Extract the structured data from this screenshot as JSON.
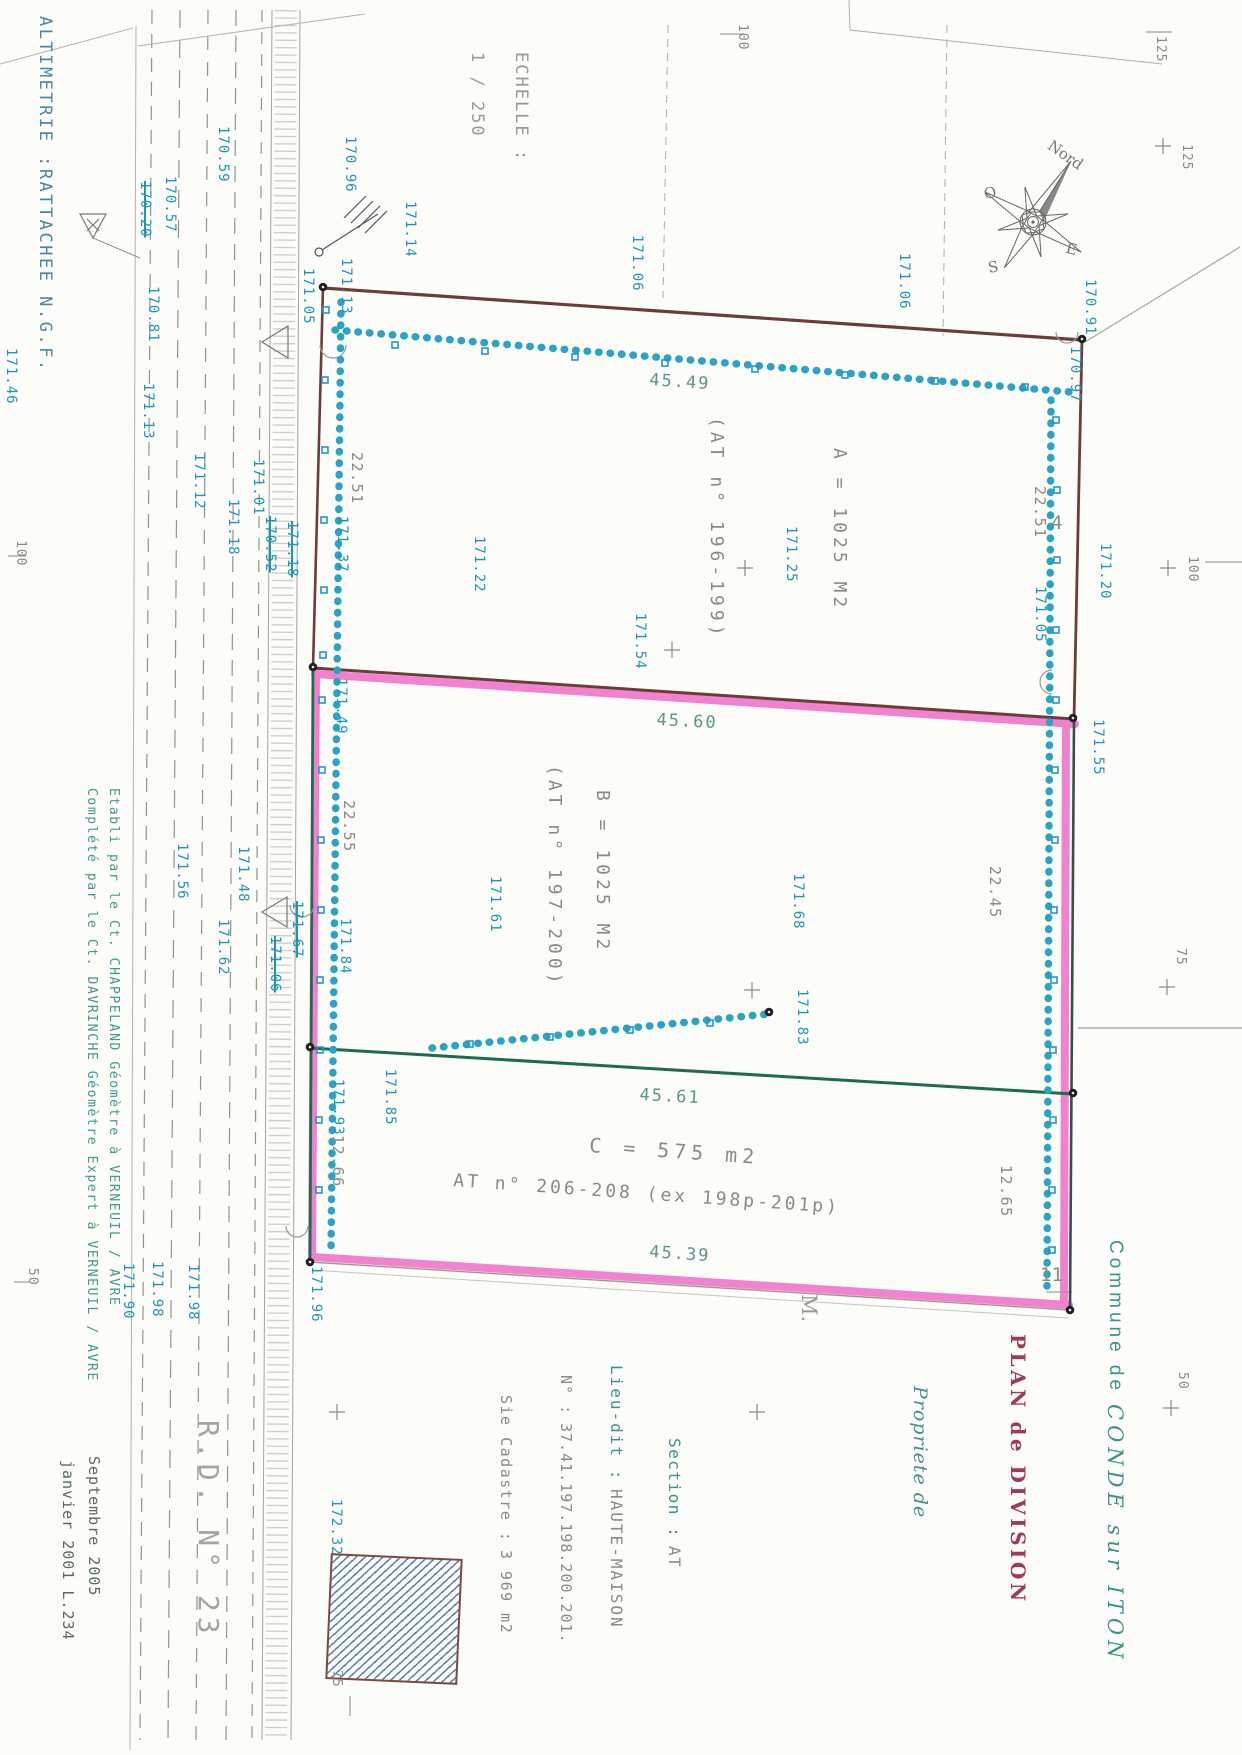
{
  "plan": {
    "altimetrie": "ALTIMETRIE :RATTACHEE N.G.F.",
    "scale_label": "ECHELLE :",
    "scale_value": "1 / 250",
    "road_name": "R.D. N° 23",
    "compass": {
      "north": "Nord",
      "west": "O",
      "east": "E",
      "south": "S"
    }
  },
  "title_block": {
    "commune_label": "Commune de",
    "commune_name": "CONDE sur ITON",
    "plan_title": "PLAN de DIVISION",
    "owner_label": "Propriete de",
    "owner_name": "M.",
    "section_label": "Section :",
    "section_value": "AT",
    "lieu_label": "Lieu-dit :",
    "lieu_value": "HAUTE-MAISON",
    "numero_label": "N° :",
    "numero_value": "37.41.197.198.200.201.",
    "cadastre_label": "Sie Cadastre :",
    "cadastre_value": "3 969 m2"
  },
  "credits": {
    "line1": "Complété par le Ct. DAVRINCHE  Géomètre Expert à VERNEUIL / AVRE",
    "line2": "Etabli par le Ct. CHAPPELAND  Géomètre à VERNEUIL / AVRE",
    "date1": "Septembre 2005",
    "date2": "janvier 2001  L.234"
  },
  "parcels": [
    {
      "id": "A",
      "area": "A = 1025 M2",
      "at": "(AT n° 196-199)"
    },
    {
      "id": "B",
      "area": "B = 1025 M2",
      "at": "(AT n° 197-200)"
    },
    {
      "id": "C",
      "area": "C = 575 m2",
      "at": "AT n° 206-208 (ex 198p-201p)"
    }
  ],
  "dimensions": [
    {
      "v": "45.49"
    },
    {
      "v": "45.60"
    },
    {
      "v": "45.61"
    },
    {
      "v": "45.39"
    },
    {
      "v": "22.51"
    },
    {
      "v": "22.51"
    },
    {
      "v": "22.55"
    },
    {
      "v": "22.45"
    },
    {
      "v": "12.66"
    },
    {
      "v": "12.65"
    }
  ],
  "point_numbers": [
    {
      "v": "4"
    },
    {
      "v": "11"
    }
  ],
  "grid_marks": [
    "125",
    "125",
    "100",
    "100",
    "75",
    "50",
    "100",
    "50",
    "75"
  ],
  "spot_elevations": [
    {
      "v": "170.57"
    },
    {
      "v": "170.20",
      "struck": true
    },
    {
      "v": "170.81"
    },
    {
      "v": "171.46"
    },
    {
      "v": "171.13"
    },
    {
      "v": "170.59"
    },
    {
      "v": "170.96"
    },
    {
      "v": "171.14"
    },
    {
      "v": "171.05"
    },
    {
      "v": "171.13"
    },
    {
      "v": "171.06"
    },
    {
      "v": "171.06"
    },
    {
      "v": "170.91"
    },
    {
      "v": "170.97"
    },
    {
      "v": "171.12"
    },
    {
      "v": "171.01"
    },
    {
      "v": "171.18"
    },
    {
      "v": "170.52",
      "struck": true
    },
    {
      "v": "171.18",
      "struck": true
    },
    {
      "v": "171.37"
    },
    {
      "v": "171.25"
    },
    {
      "v": "171.22"
    },
    {
      "v": "171.54"
    },
    {
      "v": "171.20"
    },
    {
      "v": "171.05"
    },
    {
      "v": "171.49"
    },
    {
      "v": "171.55"
    },
    {
      "v": "171.56"
    },
    {
      "v": "171.48"
    },
    {
      "v": "171.62"
    },
    {
      "v": "171.67",
      "struck": true
    },
    {
      "v": "171.06",
      "struck": true
    },
    {
      "v": "171.84"
    },
    {
      "v": "171.61"
    },
    {
      "v": "171.68"
    },
    {
      "v": "171.83"
    },
    {
      "v": "171.85"
    },
    {
      "v": "171.93"
    },
    {
      "v": "171.96"
    },
    {
      "v": "171.90"
    },
    {
      "v": "171.98"
    },
    {
      "v": "171.98"
    },
    {
      "v": "172.32"
    }
  ],
  "colors": {
    "boundary_red": "#6e3c38",
    "division_pink": "#ee63c4",
    "boundary_green": "#1e6b50",
    "spot_blue": "#1f96b4",
    "title_red": "#a03a57",
    "teal": "#3a9488"
  }
}
